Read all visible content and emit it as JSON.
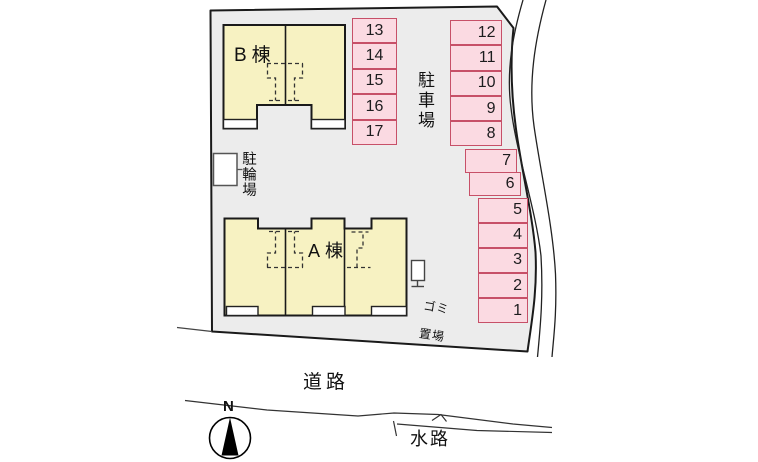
{
  "plan": {
    "building_b": {
      "label": "B棟"
    },
    "building_a": {
      "label": "A棟"
    },
    "parking_lot_label": "駐車場",
    "bicycle_parking_label": "駐輪場",
    "garbage_label_line1": "ゴミ",
    "garbage_label_line2": "置場",
    "parking_stalls": {
      "left_column": [
        "13",
        "14",
        "15",
        "16",
        "17"
      ],
      "right_upper_column": [
        "12",
        "11",
        "10",
        "9",
        "8"
      ],
      "right_middle": [
        "7",
        "6"
      ],
      "right_lower_column": [
        "5",
        "4",
        "3",
        "2",
        "1"
      ]
    }
  },
  "surroundings": {
    "road_label": "道路",
    "waterway_label": "水路"
  },
  "compass": {
    "north_label": "N"
  },
  "colors": {
    "site_fill": "#ececec",
    "building_fill": "#f7f2c2",
    "stall_fill": "#fbdae2",
    "stall_border": "#c75068",
    "outline": "#1a1a1a"
  }
}
